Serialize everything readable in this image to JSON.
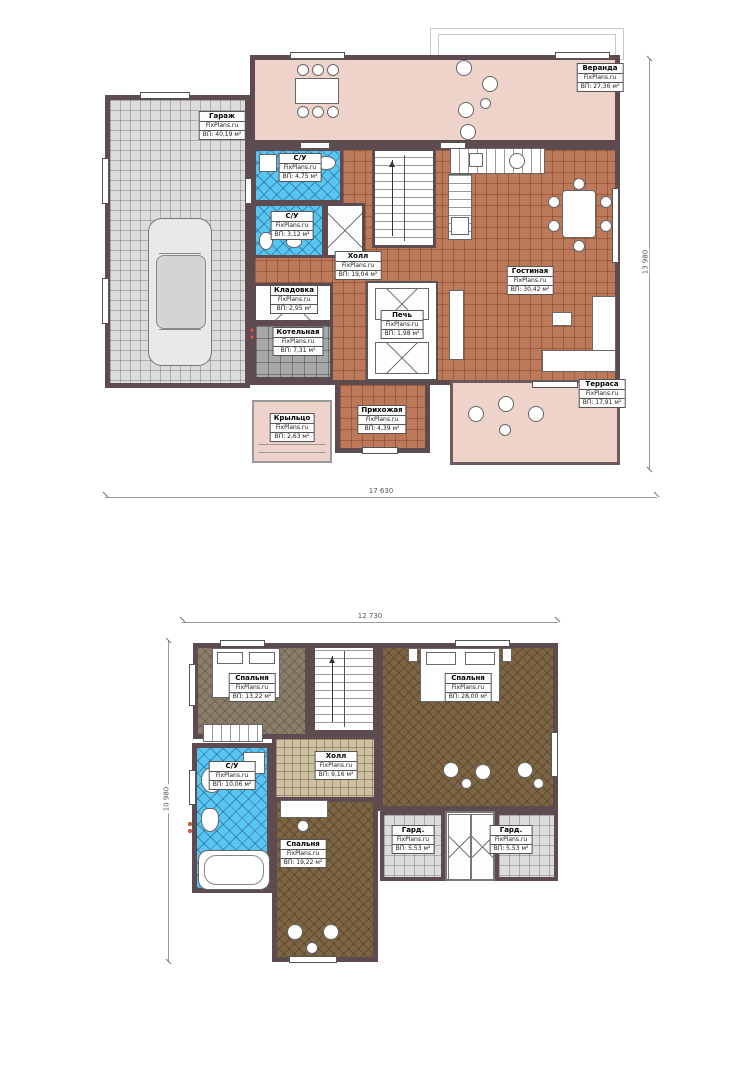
{
  "brand": "FixPlans.ru",
  "colors": {
    "wall": "#5e4b50",
    "floor_tile": "#bd7a5b",
    "veranda_pink": "#eed3cb",
    "garage_tile": "#dcdcdc",
    "bath_tile": "#58c6ef",
    "boiler_tile": "#a8a8a8",
    "wood_light": "#8a7d6a",
    "wood_dark": "#7d6544",
    "hall2_tile": "#cfc0a0",
    "accent_dot": "#e07b35"
  },
  "floor1": {
    "dim_width": "17 630",
    "dim_height": "13 980",
    "rooms": [
      {
        "name": "Веранда",
        "area": "ВП: 27,36 м²"
      },
      {
        "name": "Гараж",
        "area": "ВП: 40,19 м²"
      },
      {
        "name": "С/У",
        "area": "ВП: 4,75 м²"
      },
      {
        "name": "С/У",
        "area": "ВП: 3,12 м²"
      },
      {
        "name": "Кладовка",
        "area": "ВП: 2,95 м²"
      },
      {
        "name": "Котельная",
        "area": "ВП: 7,31 м²"
      },
      {
        "name": "Холл",
        "area": "ВП: 19,04 м²"
      },
      {
        "name": "Печь",
        "area": "ВП: 1,98 м²"
      },
      {
        "name": "Гостиная",
        "area": "ВП: 30,42 м²"
      },
      {
        "name": "Прихожая",
        "area": "ВП: 4,39 м²"
      },
      {
        "name": "Крыльцо",
        "area": "ВП: 2,63 м²"
      },
      {
        "name": "Терраса",
        "area": "ВП: 17,91 м²"
      }
    ]
  },
  "floor2": {
    "dim_width": "12 730",
    "dim_height": "10 980",
    "rooms": [
      {
        "name": "Спальня",
        "area": "ВП: 13,22 м²"
      },
      {
        "name": "Спальня",
        "area": "ВП: 28,00 м²"
      },
      {
        "name": "С/У",
        "area": "ВП: 10,06 м²"
      },
      {
        "name": "Холл",
        "area": "ВП: 9,16 м²"
      },
      {
        "name": "Спальня",
        "area": "ВП: 19,22 м²"
      },
      {
        "name": "Гард.",
        "area": "ВП: 5,53 м²"
      },
      {
        "name": "Гард.",
        "area": "ВП: 5,53 м²"
      }
    ]
  }
}
